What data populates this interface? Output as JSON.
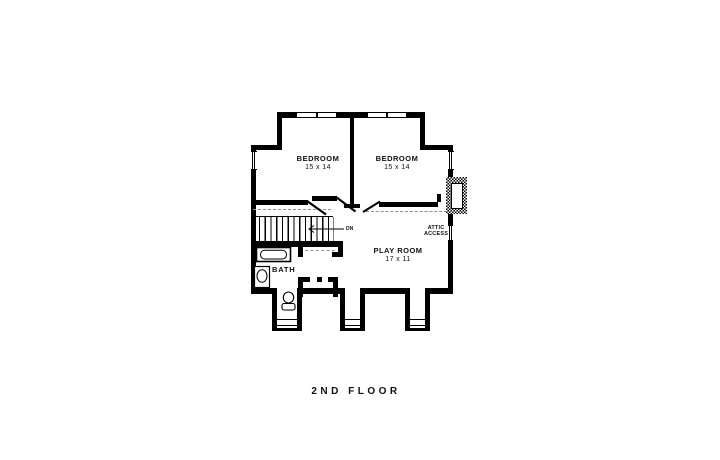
{
  "title": {
    "text": "2ND FLOOR"
  },
  "rooms": {
    "bedroom_left": {
      "name": "BEDROOM",
      "size": "15 x 14"
    },
    "bedroom_right": {
      "name": "BEDROOM",
      "size": "15 x 14"
    },
    "play_room": {
      "name": "PLAY ROOM",
      "size": "17 x 11"
    },
    "bath": {
      "name": "BATH"
    }
  },
  "annotations": {
    "attic_access": {
      "line1": "ATTIC",
      "line2": "ACCESS"
    },
    "stairs": {
      "direction_label": "DN"
    }
  },
  "fixtures": [
    "bathtub",
    "sink",
    "toilet",
    "chimney",
    "stairs-down",
    "closet-rod",
    "window"
  ],
  "colors": {
    "wall": "#000000",
    "background": "#ffffff",
    "dashed_line": "#8f8f8f",
    "text": "#111111"
  }
}
